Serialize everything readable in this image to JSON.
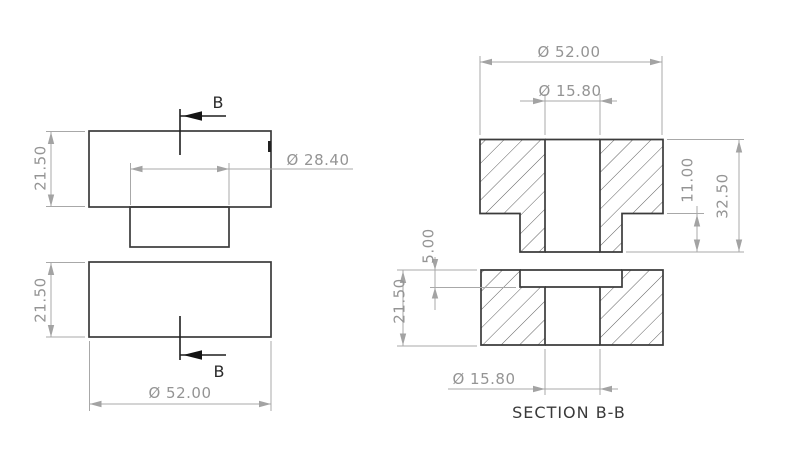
{
  "colors": {
    "background": "#ffffff",
    "outline": "#3b3b3b",
    "dimension_line": "#a8a8a8",
    "dimension_text": "#949494",
    "hatch": "#4d4d4d",
    "section_marker": "#1f1f1f"
  },
  "front_view": {
    "dim_height_top": "21.50",
    "dim_height_bottom": "21.50",
    "dim_boss_diameter": "Ø 28.40",
    "dim_outer_diameter": "Ø 52.00",
    "cut_label_top": "B",
    "cut_label_bottom": "B"
  },
  "section_view": {
    "title": "SECTION B-B",
    "dim_outer_diameter": "Ø 52.00",
    "dim_hole_diameter_top": "Ø 15.80",
    "dim_boss_height": "11.00",
    "dim_total_height": "32.50",
    "dim_recess_depth": "5.00",
    "dim_body_height": "21.50",
    "dim_hole_diameter_bottom": "Ø 15.80"
  }
}
